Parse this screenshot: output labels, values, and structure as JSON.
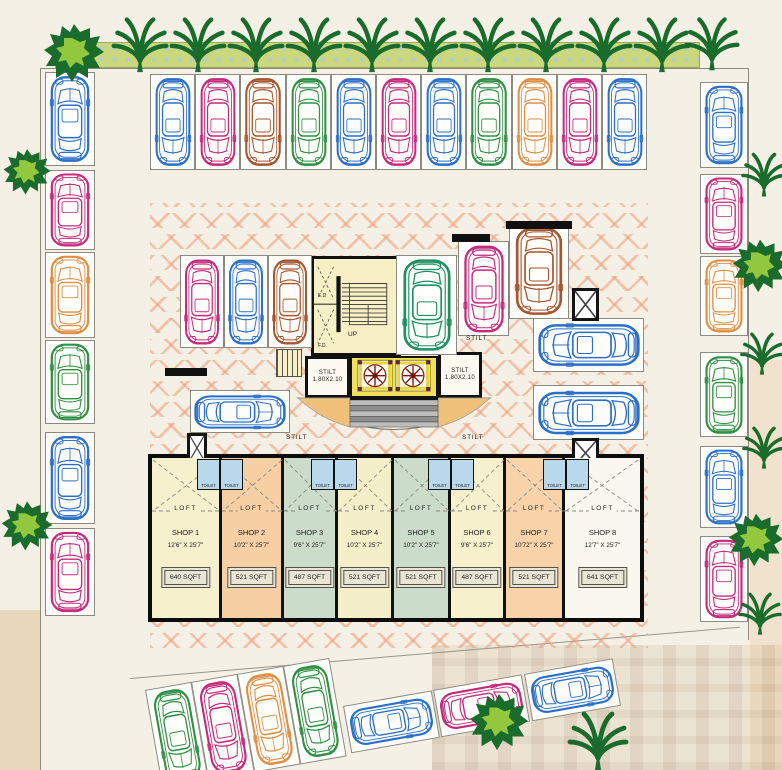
{
  "title": "Stilt parking floor plan with shops",
  "palette": {
    "blue": "#2a6fc9",
    "pink": "#c42a7d",
    "orange": "#de8f45",
    "brown": "#a3562f",
    "green": "#2f8f44",
    "teal": "#1e9160",
    "hatch": "#ee9c76",
    "hedge": "#cbd77c",
    "tree_dark": "#1a6c2c",
    "tree_light": "#93c83e",
    "lift_yellow": "#f2e05a",
    "stair_cream": "#f7f0c4",
    "toilet_blue": "#b9d8ec"
  },
  "labels": {
    "up": "UP",
    "ed": "E.D",
    "fd": "F.D.",
    "loft": "LOFT",
    "toilet": "TOILET",
    "stilt": "STILT",
    "lift_size": "1.80X2.10"
  },
  "stilt_texts": [
    {
      "x": 286,
      "y": 434,
      "t": "STILT"
    },
    {
      "x": 462,
      "y": 434,
      "t": "STILT"
    },
    {
      "x": 466,
      "y": 335,
      "t": "STILT"
    }
  ],
  "shops": [
    {
      "name": "SHOP 1",
      "dims": "12'6\" X 25'7\"",
      "area": "640 SQFT",
      "x": 152,
      "w": 70,
      "fill": "#f6f1cc"
    },
    {
      "name": "SHOP 2",
      "dims": "10'2\" X 25'7\"",
      "area": "521 SQFT",
      "x": 222,
      "w": 62,
      "fill": "#f6cfa4"
    },
    {
      "name": "SHOP 3",
      "dims": "9'6\" X 25'7\"",
      "area": "487 SQFT",
      "x": 284,
      "w": 54,
      "fill": "#ccdcca"
    },
    {
      "name": "SHOP 4",
      "dims": "10'2\" X 25'7\"",
      "area": "521 SQFT",
      "x": 338,
      "w": 56,
      "fill": "#f4efc9"
    },
    {
      "name": "SHOP 5",
      "dims": "10'2\" X 25'7\"",
      "area": "521 SQFT",
      "x": 394,
      "w": 57,
      "fill": "#ccdcca"
    },
    {
      "name": "SHOP 6",
      "dims": "9'6\" X 25'7\"",
      "area": "487 SQFT",
      "x": 451,
      "w": 55,
      "fill": "#f6f1cc"
    },
    {
      "name": "SHOP 7",
      "dims": "10'72\" X 25'7\"",
      "area": "521 SQFT",
      "x": 506,
      "w": 59,
      "fill": "#f8d2a8"
    },
    {
      "name": "SHOP 8",
      "dims": "12'7\" X 25'7\"",
      "area": "641 SQFT",
      "x": 565,
      "w": 75,
      "fill": "#faf8ee"
    }
  ],
  "toilets": [
    {
      "x": 197
    },
    {
      "x": 220
    },
    {
      "x": 311
    },
    {
      "x": 334
    },
    {
      "x": 428
    },
    {
      "x": 451
    },
    {
      "x": 543
    },
    {
      "x": 566
    }
  ],
  "parking": {
    "stalls": [
      {
        "x": 150,
        "y": 74,
        "w": 45,
        "h": 96,
        "car": "blue",
        "cr": 180
      },
      {
        "x": 195,
        "y": 74,
        "w": 45,
        "h": 96,
        "car": "pink",
        "cr": 180
      },
      {
        "x": 240,
        "y": 74,
        "w": 46,
        "h": 96,
        "car": "brown",
        "cr": 180
      },
      {
        "x": 286,
        "y": 74,
        "w": 45,
        "h": 96,
        "car": "green",
        "cr": 180
      },
      {
        "x": 331,
        "y": 74,
        "w": 45,
        "h": 96,
        "car": "blue",
        "cr": 180
      },
      {
        "x": 376,
        "y": 74,
        "w": 45,
        "h": 96,
        "car": "pink",
        "cr": 180
      },
      {
        "x": 421,
        "y": 74,
        "w": 45,
        "h": 96,
        "car": "blue",
        "cr": 180
      },
      {
        "x": 466,
        "y": 74,
        "w": 46,
        "h": 96,
        "car": "green",
        "cr": 180
      },
      {
        "x": 512,
        "y": 74,
        "w": 45,
        "h": 96,
        "car": "orange",
        "cr": 180
      },
      {
        "x": 557,
        "y": 74,
        "w": 45,
        "h": 96,
        "car": "pink",
        "cr": 180
      },
      {
        "x": 602,
        "y": 74,
        "w": 45,
        "h": 96,
        "car": "blue",
        "cr": 180
      },
      {
        "x": 45,
        "y": 72,
        "w": 50,
        "h": 94,
        "car": "blue",
        "cr": 0
      },
      {
        "x": 45,
        "y": 170,
        "w": 50,
        "h": 80,
        "car": "pink",
        "cr": 0
      },
      {
        "x": 45,
        "y": 252,
        "w": 50,
        "h": 86,
        "car": "orange",
        "cr": 0
      },
      {
        "x": 45,
        "y": 340,
        "w": 50,
        "h": 84,
        "car": "green",
        "cr": 0
      },
      {
        "x": 45,
        "y": 432,
        "w": 50,
        "h": 92,
        "car": "blue",
        "cr": 0
      },
      {
        "x": 45,
        "y": 528,
        "w": 50,
        "h": 88,
        "car": "pink",
        "cr": 0
      },
      {
        "x": 700,
        "y": 82,
        "w": 48,
        "h": 86,
        "car": "blue",
        "cr": 0
      },
      {
        "x": 700,
        "y": 174,
        "w": 48,
        "h": 80,
        "car": "pink",
        "cr": 0
      },
      {
        "x": 700,
        "y": 256,
        "w": 48,
        "h": 80,
        "car": "orange",
        "cr": 0
      },
      {
        "x": 700,
        "y": 352,
        "w": 48,
        "h": 85,
        "car": "green",
        "cr": 0
      },
      {
        "x": 700,
        "y": 446,
        "w": 48,
        "h": 82,
        "car": "blue",
        "cr": 0
      },
      {
        "x": 700,
        "y": 536,
        "w": 48,
        "h": 86,
        "car": "pink",
        "cr": 0
      },
      {
        "x": 180,
        "y": 255,
        "w": 44,
        "h": 93,
        "car": "pink",
        "cr": 180
      },
      {
        "x": 224,
        "y": 255,
        "w": 44,
        "h": 93,
        "car": "blue",
        "cr": 180
      },
      {
        "x": 268,
        "y": 255,
        "w": 44,
        "h": 93,
        "car": "brown",
        "cr": 180
      },
      {
        "x": 190,
        "y": 390,
        "w": 100,
        "h": 43,
        "car": "blue",
        "cr": 90
      },
      {
        "x": 396,
        "y": 255,
        "w": 61,
        "h": 100,
        "car": "teal",
        "cr": 180
      },
      {
        "x": 458,
        "y": 241,
        "w": 51,
        "h": 95,
        "car": "pink",
        "cr": 180
      },
      {
        "x": 509,
        "y": 223,
        "w": 60,
        "h": 96,
        "car": "brown",
        "cr": 180
      },
      {
        "x": 533,
        "y": 318,
        "w": 111,
        "h": 54,
        "car": "blue",
        "cr": -90
      },
      {
        "x": 533,
        "y": 385,
        "w": 111,
        "h": 55,
        "car": "blue",
        "cr": -90
      },
      {
        "x": 145,
        "y": 690,
        "w": 47,
        "h": 100,
        "car": "green",
        "cr": 180,
        "r": -10
      },
      {
        "x": 191,
        "y": 682,
        "w": 47,
        "h": 100,
        "car": "pink",
        "cr": 180,
        "r": -10
      },
      {
        "x": 237,
        "y": 674,
        "w": 47,
        "h": 100,
        "car": "orange",
        "cr": 180,
        "r": -10
      },
      {
        "x": 283,
        "y": 666,
        "w": 47,
        "h": 100,
        "car": "green",
        "cr": 180,
        "r": -10
      },
      {
        "x": 343,
        "y": 706,
        "w": 90,
        "h": 48,
        "car": "blue",
        "cr": 90,
        "r": -10
      },
      {
        "x": 433,
        "y": 690,
        "w": 90,
        "h": 48,
        "car": "pink",
        "cr": 90,
        "r": -10
      },
      {
        "x": 524,
        "y": 674,
        "w": 90,
        "h": 48,
        "car": "blue",
        "cr": 90,
        "r": -10
      }
    ]
  },
  "ducts": [
    {
      "x": 187,
      "y": 433,
      "w": 20,
      "h": 30
    },
    {
      "x": 572,
      "y": 288,
      "w": 27,
      "h": 33
    },
    {
      "x": 572,
      "y": 438,
      "w": 27,
      "h": 30
    }
  ],
  "walls": [
    {
      "x": 165,
      "y": 368,
      "w": 42,
      "h": 8
    },
    {
      "x": 452,
      "y": 234,
      "w": 38,
      "h": 8
    },
    {
      "x": 506,
      "y": 221,
      "w": 66,
      "h": 8
    }
  ],
  "trees": [
    {
      "type": "bush",
      "x": 42,
      "y": 20,
      "s": 64
    },
    {
      "type": "palm",
      "x": 110,
      "y": 14,
      "s": 60
    },
    {
      "type": "palm",
      "x": 168,
      "y": 14,
      "s": 60
    },
    {
      "type": "palm",
      "x": 226,
      "y": 14,
      "s": 60
    },
    {
      "type": "palm",
      "x": 284,
      "y": 14,
      "s": 60
    },
    {
      "type": "palm",
      "x": 342,
      "y": 14,
      "s": 60
    },
    {
      "type": "palm",
      "x": 400,
      "y": 14,
      "s": 60
    },
    {
      "type": "palm",
      "x": 458,
      "y": 14,
      "s": 60
    },
    {
      "type": "palm",
      "x": 516,
      "y": 14,
      "s": 60
    },
    {
      "type": "palm",
      "x": 574,
      "y": 14,
      "s": 60
    },
    {
      "type": "palm",
      "x": 632,
      "y": 14,
      "s": 60
    },
    {
      "type": "palm",
      "x": 683,
      "y": 14,
      "s": 58
    },
    {
      "type": "bush",
      "x": 2,
      "y": 146,
      "s": 50
    },
    {
      "type": "bush",
      "x": 0,
      "y": 498,
      "s": 54
    },
    {
      "type": "palm",
      "x": 740,
      "y": 150,
      "s": 48
    },
    {
      "type": "bush",
      "x": 731,
      "y": 236,
      "s": 58
    },
    {
      "type": "palm",
      "x": 739,
      "y": 330,
      "s": 46
    },
    {
      "type": "palm",
      "x": 741,
      "y": 424,
      "s": 46
    },
    {
      "type": "bush",
      "x": 727,
      "y": 510,
      "s": 58
    },
    {
      "type": "palm",
      "x": 737,
      "y": 590,
      "s": 46
    },
    {
      "type": "bush",
      "x": 468,
      "y": 690,
      "s": 62
    },
    {
      "type": "palm",
      "x": 566,
      "y": 708,
      "s": 64
    }
  ]
}
